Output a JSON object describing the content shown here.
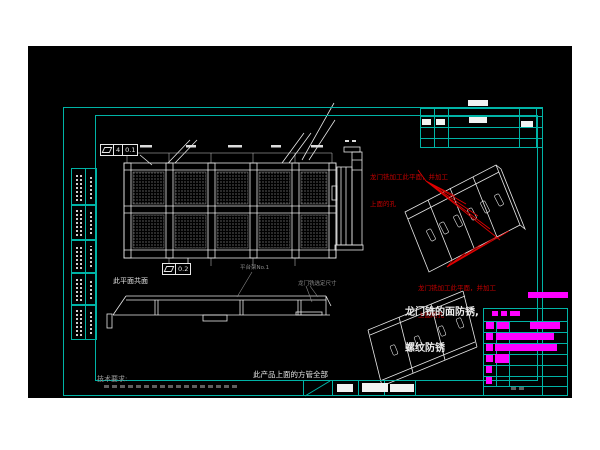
{
  "colors": {
    "canvas_bg": "#000000",
    "page_bg": "#ffffff",
    "frame_teal": "#00b3a6",
    "line_white": "#e8e8e8",
    "highlight_magenta": "#ff00ff",
    "annotation_red": "#c40000",
    "label_gray": "#8a8a8a"
  },
  "plan": {
    "gdt_upper": {
      "a": "4",
      "b": "0.1"
    },
    "gdt_lower": {
      "a": "0.2"
    }
  },
  "notes": {
    "coplanar": "此平面共面",
    "platform": "平台架No.1",
    "gantry_dim": "龙门铣选定尺寸",
    "red_top_l1": "龙门铣加工此平面，并加工",
    "red_top_l2": "上面的孔",
    "red_mid_l1": "龙门铣加工此平面，并加工",
    "red_mid_l2": "上面的孔",
    "antirust_l1": "龙门铣的面防锈,",
    "antirust_l2": "螺纹防锈",
    "tube_l1": "此产品上面的方管全部",
    "tube_l2": "为150*150*10.0方管",
    "tech_title": "技术要求:"
  }
}
